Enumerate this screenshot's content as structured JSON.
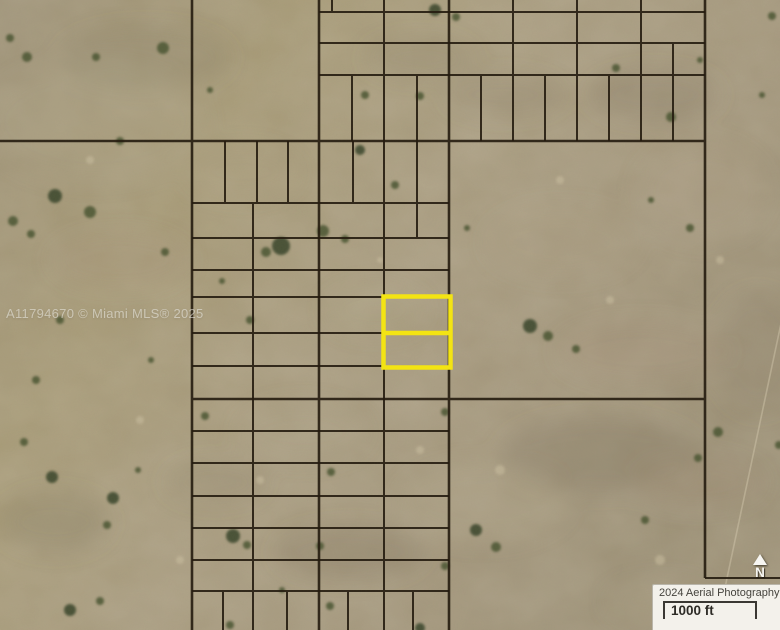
{
  "map": {
    "watermark_text": "A11794670 © Miami MLS® 2025"
  },
  "north_indicator": {
    "label": "N"
  },
  "info_box": {
    "aerial_label": "2024 Aerial Photography",
    "scale_label": "1000 ft"
  },
  "colors": {
    "parcel_highlight": "#F3E413",
    "parcel_line": "#251C10",
    "terrain_base": "#A49877",
    "info_box_background": "#F3F1EB",
    "info_text": "#45433D",
    "watermark": "#E1DFD7"
  }
}
